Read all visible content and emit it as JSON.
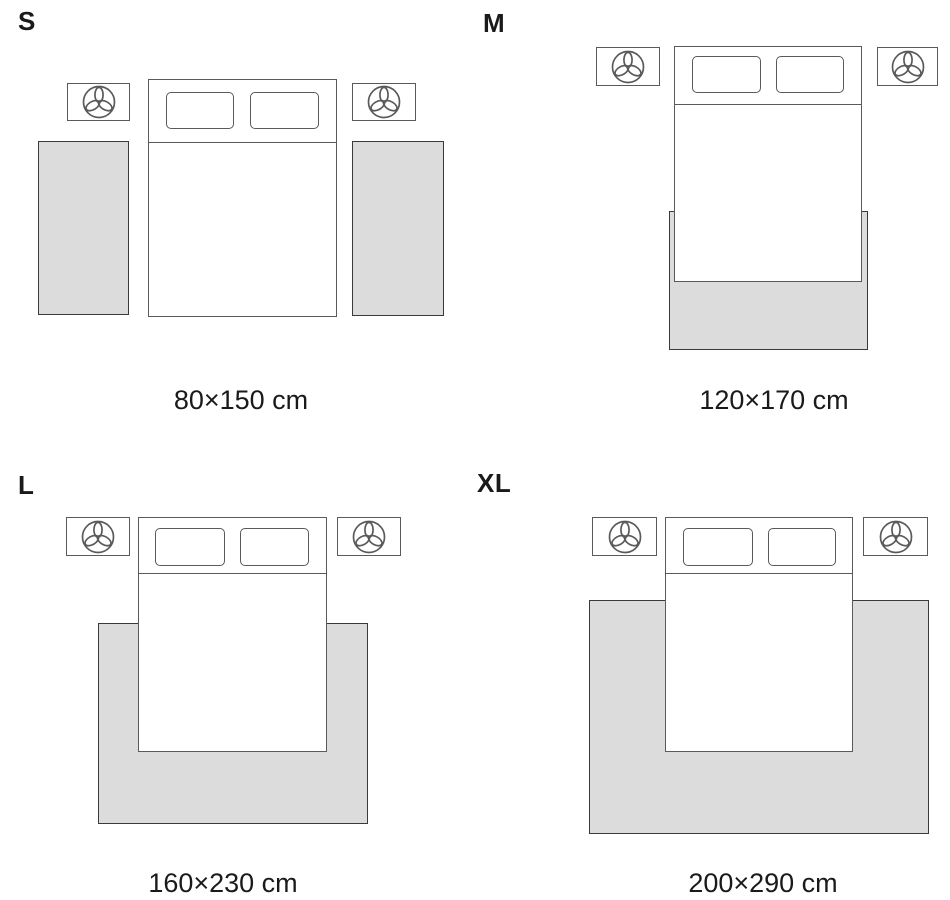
{
  "title": "Rug size guide with bed layouts",
  "colors": {
    "page_bg": "#ffffff",
    "rug_fill": "#dcdcdc",
    "rug_border": "#3a3a3a",
    "furniture_border": "#5a5a5a",
    "text_color": "#1a1a1a"
  },
  "icons": {
    "nightstand_icon": "plant-icon"
  },
  "sizes": {
    "s": {
      "label": "S",
      "dimensions": "80×150 cm",
      "layout": "two runner rugs flanking the bed"
    },
    "m": {
      "label": "M",
      "dimensions": "120×170 cm",
      "layout": "rug under lower half of bed"
    },
    "l": {
      "label": "L",
      "dimensions": "160×230 cm",
      "layout": "rug under lower two-thirds of bed extending to sides"
    },
    "xl": {
      "label": "XL",
      "dimensions": "200×290 cm",
      "layout": "large rug under bed extending wide on all lower sides"
    }
  }
}
